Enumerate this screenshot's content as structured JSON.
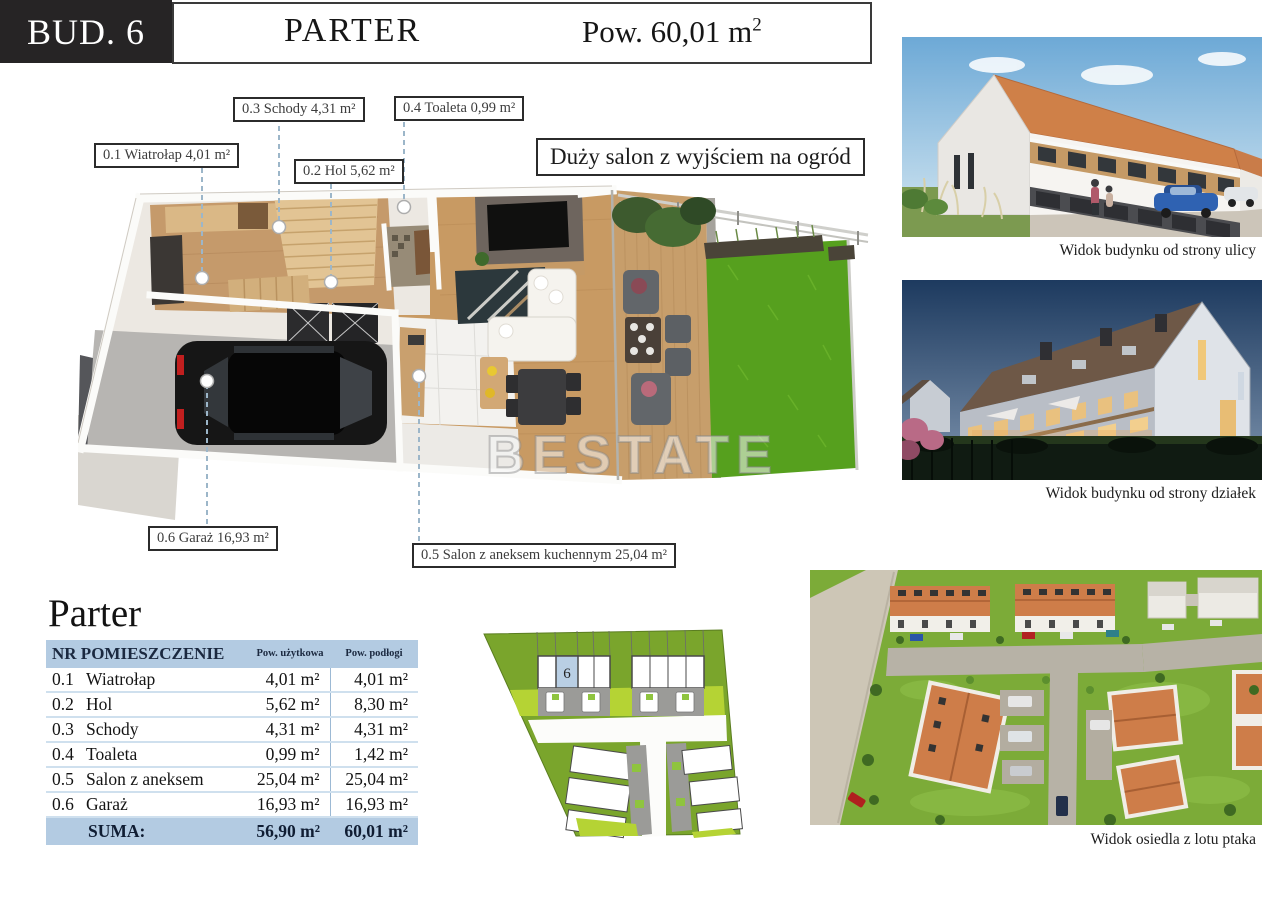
{
  "header": {
    "building": "BUD. 6",
    "floor": "PARTER",
    "area": "Pow. 60,01 m",
    "area_sup": "2"
  },
  "watermark": "BESTATE",
  "plan": {
    "callout": "Duży salon z wyjściem na ogród",
    "labels": [
      {
        "text": "0.3 Schody 4,31 m²"
      },
      {
        "text": "0.4 Toaleta 0,99 m²"
      },
      {
        "text": "0.1 Wiatrołap 4,01 m²"
      },
      {
        "text": "0.2 Hol 5,62 m²"
      },
      {
        "text": "0.6 Garaż 16,93 m²"
      },
      {
        "text": "0.5 Salon z aneksem kuchennym 25,04 m²"
      }
    ]
  },
  "table": {
    "title": "Parter",
    "headers": {
      "room": "NR POMIESZCZENIE",
      "usable": "Pow. użytkowa",
      "floor": "Pow. podłogi"
    },
    "rows": [
      {
        "nr": "0.1",
        "name": "Wiatrołap",
        "usable": "4,01 m²",
        "floor": "4,01 m²"
      },
      {
        "nr": "0.2",
        "name": "Hol",
        "usable": "5,62 m²",
        "floor": "8,30 m²"
      },
      {
        "nr": "0.3",
        "name": "Schody",
        "usable": "4,31 m²",
        "floor": "4,31 m²"
      },
      {
        "nr": "0.4",
        "name": "Toaleta",
        "usable": "0,99 m²",
        "floor": "1,42 m²"
      },
      {
        "nr": "0.5",
        "name": "Salon z aneksem",
        "usable": "25,04 m²",
        "floor": "25,04 m²"
      },
      {
        "nr": "0.6",
        "name": "Garaż",
        "usable": "16,93 m²",
        "floor": "16,93 m²"
      }
    ],
    "sum": {
      "label": "SUMA:",
      "usable": "56,90 m²",
      "floor": "60,01 m²"
    }
  },
  "siteplan": {
    "highlighted_unit": "6"
  },
  "photos": [
    {
      "caption": "Widok budynku od strony ulicy"
    },
    {
      "caption": "Widok budynku od strony działek"
    },
    {
      "caption": "Widok osiedla z lotu ptaka"
    }
  ],
  "colors": {
    "accent_blue": "#b3cbe2",
    "site_green_dark": "#7aa52c",
    "site_green_light": "#b5d334",
    "lawn_green": "#56a01e",
    "roof_orange": "#ce7d49"
  }
}
